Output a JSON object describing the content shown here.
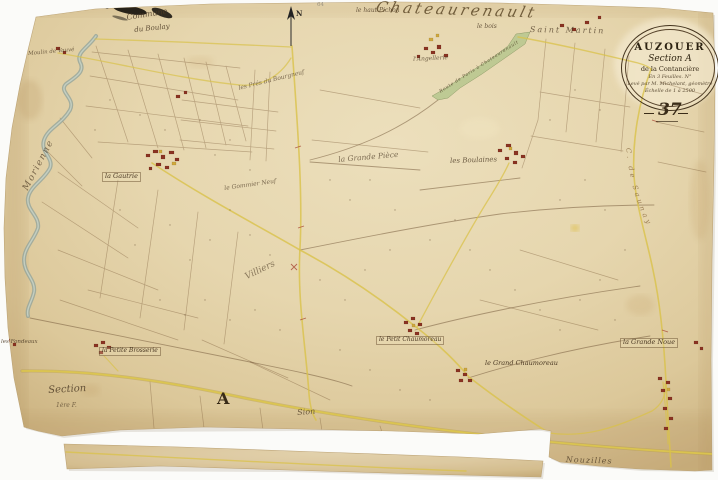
{
  "colors": {
    "paper": "#e6d6ae",
    "ink": "#4a3823",
    "road_yellow": "#d9c24a",
    "river_grey": "#93a49b",
    "route_green": "#b7c78e",
    "building_red": "#8b3322",
    "building_yellow": "#cfa93e"
  },
  "cartouche": {
    "title": "AUZOUER",
    "section": "Section A",
    "territory": "de la Contancière",
    "sheets": "En 3 Feuilles. N°",
    "surveyor": "Levé par M. Michelant, géomètre",
    "scale": "Échelle de 1 à 2500"
  },
  "sheet_number": "37",
  "compass": {
    "north": "N"
  },
  "neighbors": {
    "north_big": "Chateaurenault",
    "northwest_line1": "Commune",
    "northwest_line2": "du Boulay",
    "east_arc": "C. de Saunay",
    "west": "Morienne",
    "south": "Nouzilles"
  },
  "places": {
    "haut_pichon": "le haut Pichon",
    "le_bois": "le bois",
    "saint_martin": "Saint Martin",
    "angellerie": "l'Angellerie",
    "moulin": "Moulin de Vauvé",
    "gautrie": "la Gautrie",
    "pres_bourgneuf": "les Prés du Bourgneuf",
    "gommier_neuf": "le Gommier Neuf",
    "grande_piece": "la Grande Pièce",
    "boulaines": "les Boulaines",
    "villiers": "Villiers",
    "petite_brosserie": "la Petite Brosserie",
    "petit_chaumoreau": "le Petit Chaumoreau",
    "grand_chaumoreau": "le Grand Chaumoreau",
    "grande_noue": "la Grande Noue",
    "fondeaux": "les Fondeaux",
    "sion": "Sion"
  },
  "annotations": {
    "section_script": "Section",
    "sheet_note": "1ère F.",
    "letter_a": "A",
    "pencil": "64",
    "route": "Route de Paris à Chateaurenault"
  }
}
